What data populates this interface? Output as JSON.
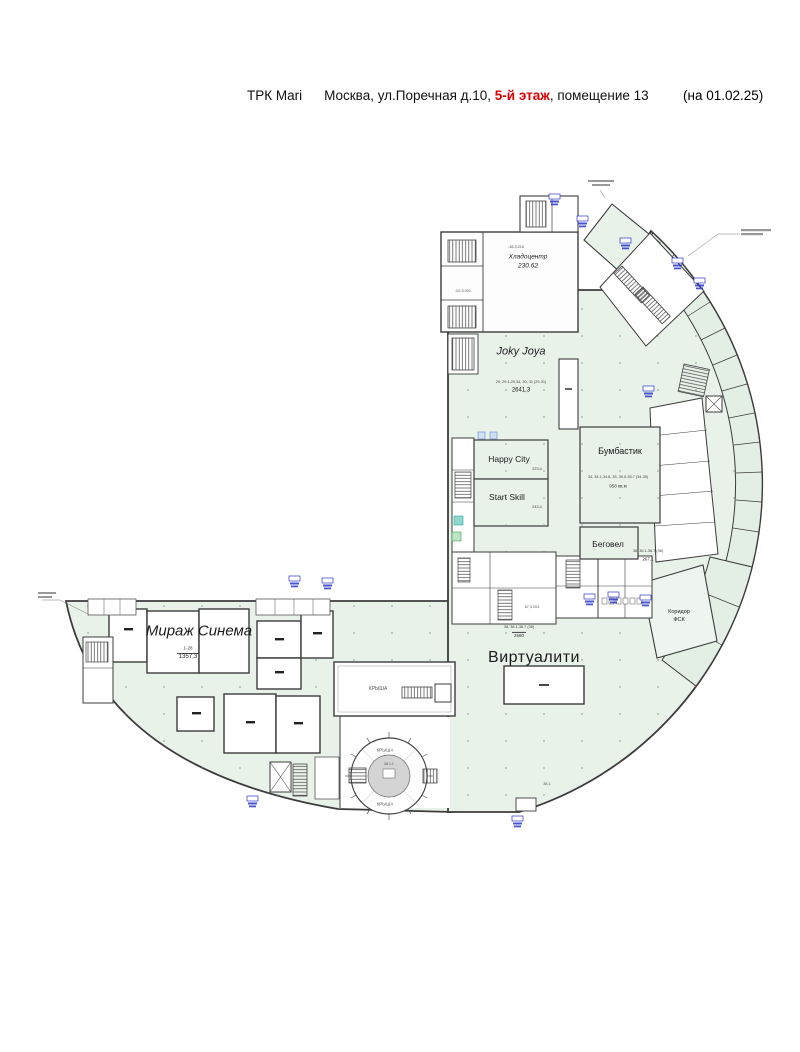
{
  "header": {
    "brand": "ТРК Mari",
    "address": "Москва, ул.Поречная д.10,",
    "floor": "5-й этаж",
    "suffix": ", помещение 13",
    "date": "(на 01.02.25)"
  },
  "zones": {
    "joky": {
      "name": "Joky Joya",
      "rooms": "29, 29.1-29.34, 30, 31 (29-31)",
      "area": "2641,3"
    },
    "hlado": {
      "name": "Хладоцентр",
      "area": "230.62"
    },
    "happy": {
      "name": "Happy City",
      "area": "223,4"
    },
    "start": {
      "name": "Start Skill",
      "area": "243,4"
    },
    "bum": {
      "name": "Бумбастик",
      "rooms": "34, 34.1-34.8, 35, 35.5-35.7 (34-35)",
      "area": "958 кв.м"
    },
    "beg": {
      "name": "Беговел",
      "rooms": "36, 36.1-36.7 (36)",
      "area": "267,1"
    },
    "virt": {
      "name": "Виртуалити",
      "rooms": "38, 38.1-38.7 (38)",
      "area": "2580"
    },
    "mirage": {
      "name": "Мираж Синема",
      "rooms": "1-28",
      "area": "1357,3"
    },
    "fsk": {
      "line1": "Коридор",
      "line2": "ФСК"
    }
  },
  "labels": {
    "roof": "КРЫША"
  },
  "annotations": {
    "a1": "-38.3.018",
    "a2": "-02.3.001",
    "a3": "87,3.003",
    "a4": "38.1",
    "a5": "38.1.1"
  },
  "colors": {
    "plan_fill": "#e8f2e9",
    "wall": "#3c3c3c",
    "accent_red": "#dd0000",
    "exit_blue": "#2a35c9",
    "rotunda_gray": "#d4d4d4"
  }
}
